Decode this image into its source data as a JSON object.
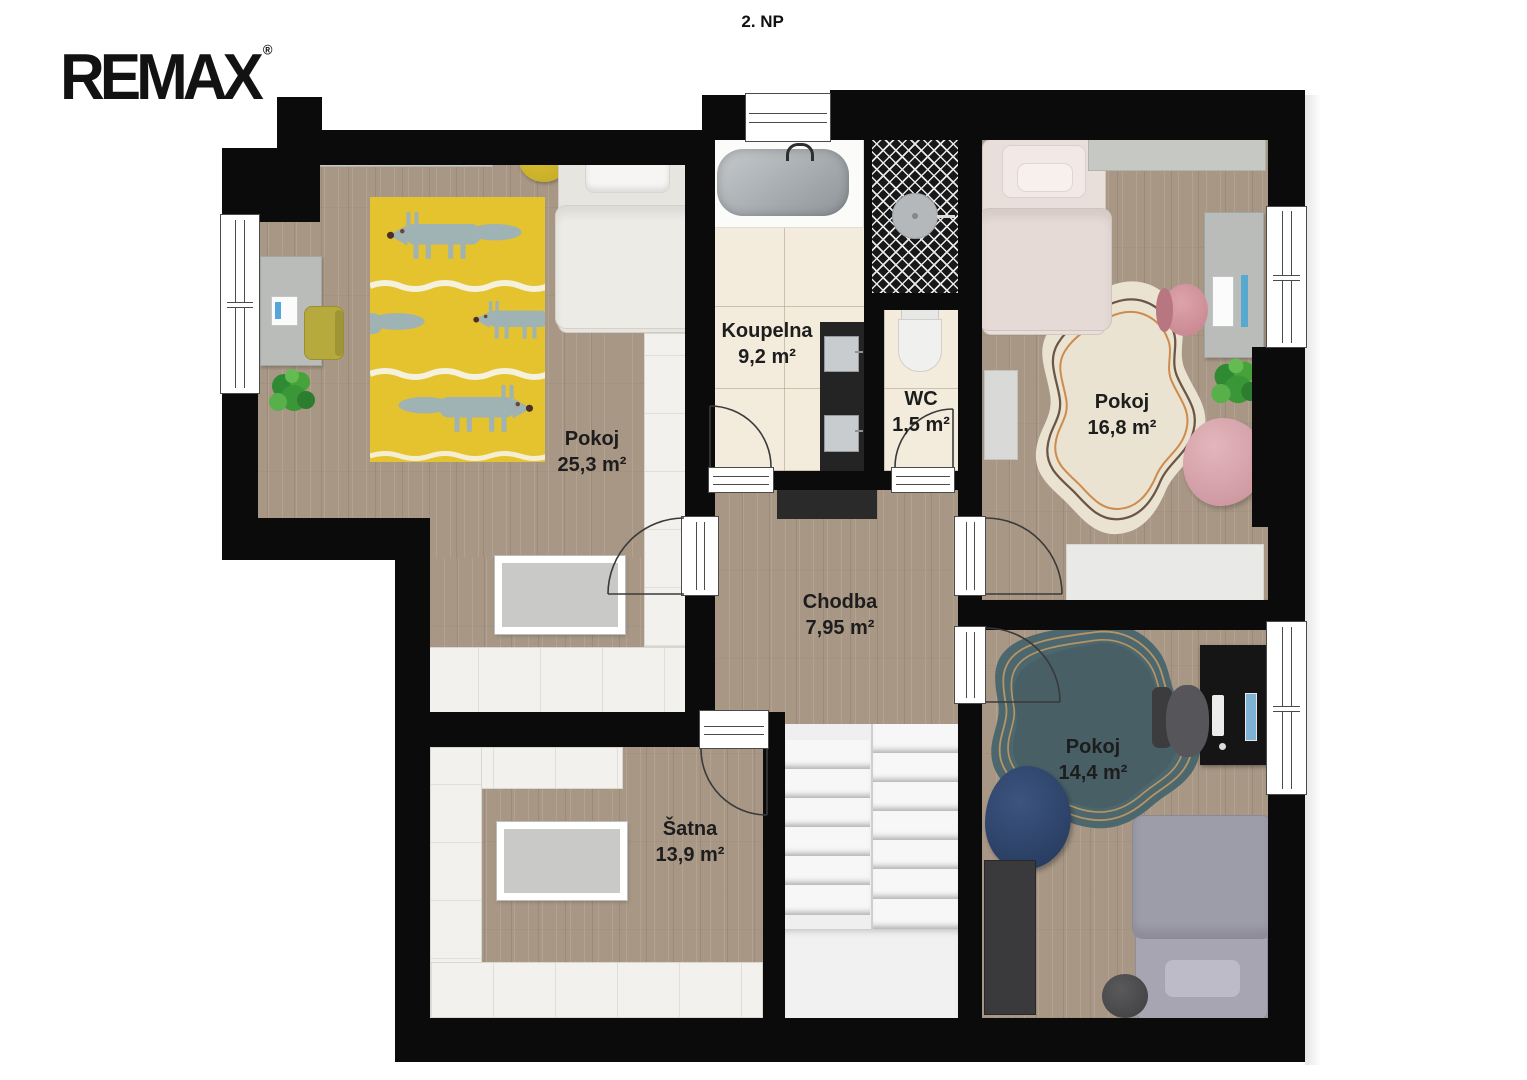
{
  "title": "2. NP",
  "logo": {
    "text": "REMAX",
    "reg": "®"
  },
  "rooms": {
    "pokoj1": {
      "name": "Pokoj",
      "area": "25,3 m²"
    },
    "koupelna": {
      "name": "Koupelna",
      "area": "9,2 m²"
    },
    "wc": {
      "name": "WC",
      "area": "1,5 m²"
    },
    "pokoj2": {
      "name": "Pokoj",
      "area": "16,8 m²"
    },
    "chodba": {
      "name": "Chodba",
      "area": "7,95 m²"
    },
    "satna": {
      "name": "Šatna",
      "area": "13,9 m²"
    },
    "pokoj3": {
      "name": "Pokoj",
      "area": "14,4 m²"
    }
  },
  "colors": {
    "wall": "#0b0b0b",
    "wood_floor": "#a89785",
    "tile_floor": "#f3ecdd",
    "fox_rug_yellow": "#e4c32f",
    "fox_gray": "#9fb2b4",
    "cream_rug": "#ebe3d2",
    "teal_rug": "#4c676d",
    "accent_pink": "#d4949c",
    "accent_navy": "#2b3f63",
    "accent_yellow": "#ccb32b",
    "plant_green": "#3b9638"
  }
}
